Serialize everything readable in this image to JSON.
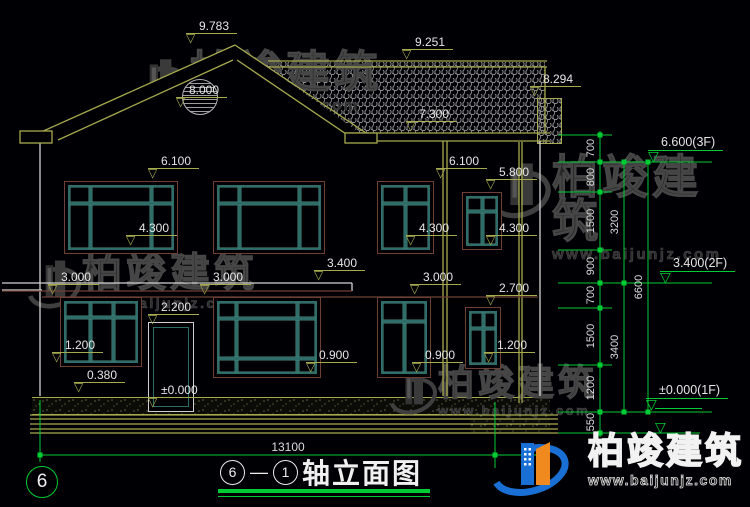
{
  "watermark": {
    "brand": "柏竣建筑",
    "url": "www.baijunjz.com"
  },
  "title_block": {
    "axis_start": "6",
    "axis_end": "1",
    "name": "轴立面图"
  },
  "axis_bubble": {
    "label": "6"
  },
  "colors": {
    "olive": "#a6a94e",
    "white": "#d4d4d4",
    "brown": "#6e4034",
    "green": "#00cc33",
    "teal": "#2f6e68",
    "text": "#e6e6e6",
    "bg": "#000004"
  },
  "drawing": {
    "elevation_markers": [
      {
        "label": "9.783",
        "x": 186,
        "y": 46
      },
      {
        "label": "9.251",
        "x": 402,
        "y": 62
      },
      {
        "label": "8.294",
        "x": 530,
        "y": 99
      },
      {
        "label": "8.000",
        "x": 176,
        "y": 110
      },
      {
        "label": "7.300",
        "x": 406,
        "y": 134
      },
      {
        "label": "6.100",
        "x": 148,
        "y": 181
      },
      {
        "label": "6.100",
        "x": 436,
        "y": 181
      },
      {
        "label": "5.800",
        "x": 486,
        "y": 192
      },
      {
        "label": "4.300",
        "x": 126,
        "y": 248
      },
      {
        "label": "4.300",
        "x": 406,
        "y": 248
      },
      {
        "label": "4.300",
        "x": 486,
        "y": 248
      },
      {
        "label": "3.400",
        "x": 314,
        "y": 283
      },
      {
        "label": "3.000",
        "x": 48,
        "y": 297
      },
      {
        "label": "3.000",
        "x": 200,
        "y": 297
      },
      {
        "label": "3.000",
        "x": 410,
        "y": 297
      },
      {
        "label": "2.700",
        "x": 486,
        "y": 308
      },
      {
        "label": "2.200",
        "x": 148,
        "y": 327
      },
      {
        "label": "1.200",
        "x": 52,
        "y": 365
      },
      {
        "label": "1.200",
        "x": 484,
        "y": 365
      },
      {
        "label": "0.900",
        "x": 306,
        "y": 375
      },
      {
        "label": "0.900",
        "x": 412,
        "y": 375
      },
      {
        "label": "0.380",
        "x": 74,
        "y": 395
      },
      {
        "label": "±0.000",
        "x": 148,
        "y": 410
      }
    ],
    "floor_markers": [
      {
        "label": "6.600(3F)",
        "x": 648,
        "y": 162
      },
      {
        "label": "3.400(2F)",
        "x": 660,
        "y": 283
      },
      {
        "label": "±0.000(1F)",
        "x": 646,
        "y": 410
      },
      {
        "label": "",
        "x": 655,
        "y": 433
      }
    ],
    "dim_texts": [
      {
        "x": 600,
        "y": 148,
        "label": "700"
      },
      {
        "x": 600,
        "y": 177,
        "label": "800"
      },
      {
        "x": 600,
        "y": 221,
        "label": "1500"
      },
      {
        "x": 600,
        "y": 266,
        "label": "900"
      },
      {
        "x": 600,
        "y": 295,
        "label": "700"
      },
      {
        "x": 600,
        "y": 336,
        "label": "1500"
      },
      {
        "x": 600,
        "y": 388,
        "label": "1200"
      },
      {
        "x": 600,
        "y": 422,
        "label": "550"
      },
      {
        "x": 624,
        "y": 222,
        "label": "3200"
      },
      {
        "x": 624,
        "y": 347,
        "label": "3400"
      },
      {
        "x": 648,
        "y": 287,
        "label": "6600"
      }
    ],
    "bottom_dim": {
      "label": "13100"
    },
    "lines": [
      [
        235,
        45,
        30,
        137,
        "o"
      ],
      [
        235,
        45,
        369,
        135,
        "o"
      ],
      [
        233,
        60,
        58,
        140,
        "o"
      ],
      [
        237,
        60,
        352,
        138,
        "o"
      ],
      [
        268,
        61,
        547,
        61,
        "o"
      ],
      [
        268,
        67,
        547,
        67,
        "o"
      ],
      [
        545,
        67,
        545,
        133,
        "o"
      ],
      [
        345,
        133,
        550,
        133,
        "o"
      ],
      [
        345,
        141,
        550,
        141,
        "o"
      ],
      [
        443,
        141,
        443,
        396,
        "o"
      ],
      [
        447,
        141,
        447,
        396,
        "o"
      ],
      [
        519,
        142,
        519,
        403,
        "o"
      ],
      [
        522,
        142,
        522,
        403,
        "o"
      ],
      [
        30,
        415,
        558,
        415,
        "o"
      ],
      [
        30,
        419,
        558,
        419,
        "o"
      ],
      [
        30,
        424,
        558,
        424,
        "o"
      ],
      [
        30,
        429,
        558,
        429,
        "o"
      ],
      [
        30,
        433,
        558,
        433,
        "o"
      ],
      [
        40,
        143,
        40,
        396,
        "w"
      ],
      [
        540,
        141,
        540,
        396,
        "w"
      ],
      [
        2,
        283,
        352,
        283,
        "w"
      ],
      [
        352,
        283,
        352,
        291,
        "w"
      ],
      [
        2,
        290,
        42,
        290,
        "w"
      ],
      [
        2,
        291,
        352,
        291,
        "b"
      ],
      [
        42,
        297,
        538,
        297,
        "b"
      ],
      [
        558,
        135,
        612,
        135,
        "g"
      ],
      [
        558,
        162,
        712,
        162,
        "g"
      ],
      [
        558,
        192,
        612,
        192,
        "g"
      ],
      [
        558,
        250,
        612,
        250,
        "g"
      ],
      [
        558,
        283,
        712,
        283,
        "g"
      ],
      [
        558,
        308,
        612,
        308,
        "g"
      ],
      [
        558,
        365,
        612,
        365,
        "g"
      ],
      [
        558,
        412,
        712,
        412,
        "g"
      ],
      [
        558,
        433,
        700,
        433,
        "g"
      ],
      [
        600,
        131,
        600,
        437,
        "g"
      ],
      [
        624,
        160,
        624,
        414,
        "g"
      ],
      [
        648,
        160,
        648,
        414,
        "g"
      ],
      [
        40,
        455,
        540,
        455,
        "g"
      ],
      [
        40,
        400,
        40,
        462,
        "g"
      ],
      [
        495,
        402,
        495,
        468,
        "g"
      ]
    ],
    "gable_fill": "235,44 30,140 370,140",
    "eave_boxes": [
      [
        20,
        131,
        32,
        12
      ],
      [
        345,
        133,
        32,
        10
      ]
    ],
    "ticks": [
      [
        600,
        135
      ],
      [
        600,
        162
      ],
      [
        600,
        192
      ],
      [
        600,
        250
      ],
      [
        600,
        283
      ],
      [
        600,
        308
      ],
      [
        600,
        365
      ],
      [
        600,
        412
      ],
      [
        600,
        433
      ],
      [
        624,
        162
      ],
      [
        624,
        283
      ],
      [
        624,
        412
      ],
      [
        648,
        162
      ],
      [
        648,
        412
      ],
      [
        40,
        455
      ],
      [
        495,
        455
      ],
      [
        540,
        455
      ]
    ],
    "windows": [
      {
        "x": 64,
        "y": 181,
        "w": 112,
        "h": 71,
        "cols": [
          0.2,
          0.8
        ],
        "rows": [
          0.27
        ]
      },
      {
        "x": 213,
        "y": 181,
        "w": 110,
        "h": 71,
        "cols": [
          0.2,
          0.8
        ],
        "rows": [
          0.27
        ]
      },
      {
        "x": 377,
        "y": 181,
        "w": 55,
        "h": 71,
        "cols": [
          0.5
        ],
        "rows": [
          0.27
        ]
      },
      {
        "x": 462,
        "y": 192,
        "w": 38,
        "h": 56,
        "cols": [
          0.5
        ],
        "rows": [
          0.3
        ]
      },
      {
        "x": 60,
        "y": 297,
        "w": 80,
        "h": 68,
        "cols": [
          0.35,
          0.68
        ],
        "rows": [
          0.25
        ]
      },
      {
        "x": 213,
        "y": 297,
        "w": 106,
        "h": 79,
        "cols": [
          0.18,
          0.82
        ],
        "rows": [
          0.22,
          0.8
        ]
      },
      {
        "x": 377,
        "y": 297,
        "w": 52,
        "h": 79,
        "cols": [
          0.5
        ],
        "rows": [
          0.27
        ]
      },
      {
        "x": 465,
        "y": 307,
        "w": 34,
        "h": 60,
        "cols": [
          0.5
        ],
        "rows": [
          0.3
        ]
      }
    ],
    "door": {
      "x": 148,
      "y": 322,
      "w": 44,
      "h": 88
    }
  }
}
